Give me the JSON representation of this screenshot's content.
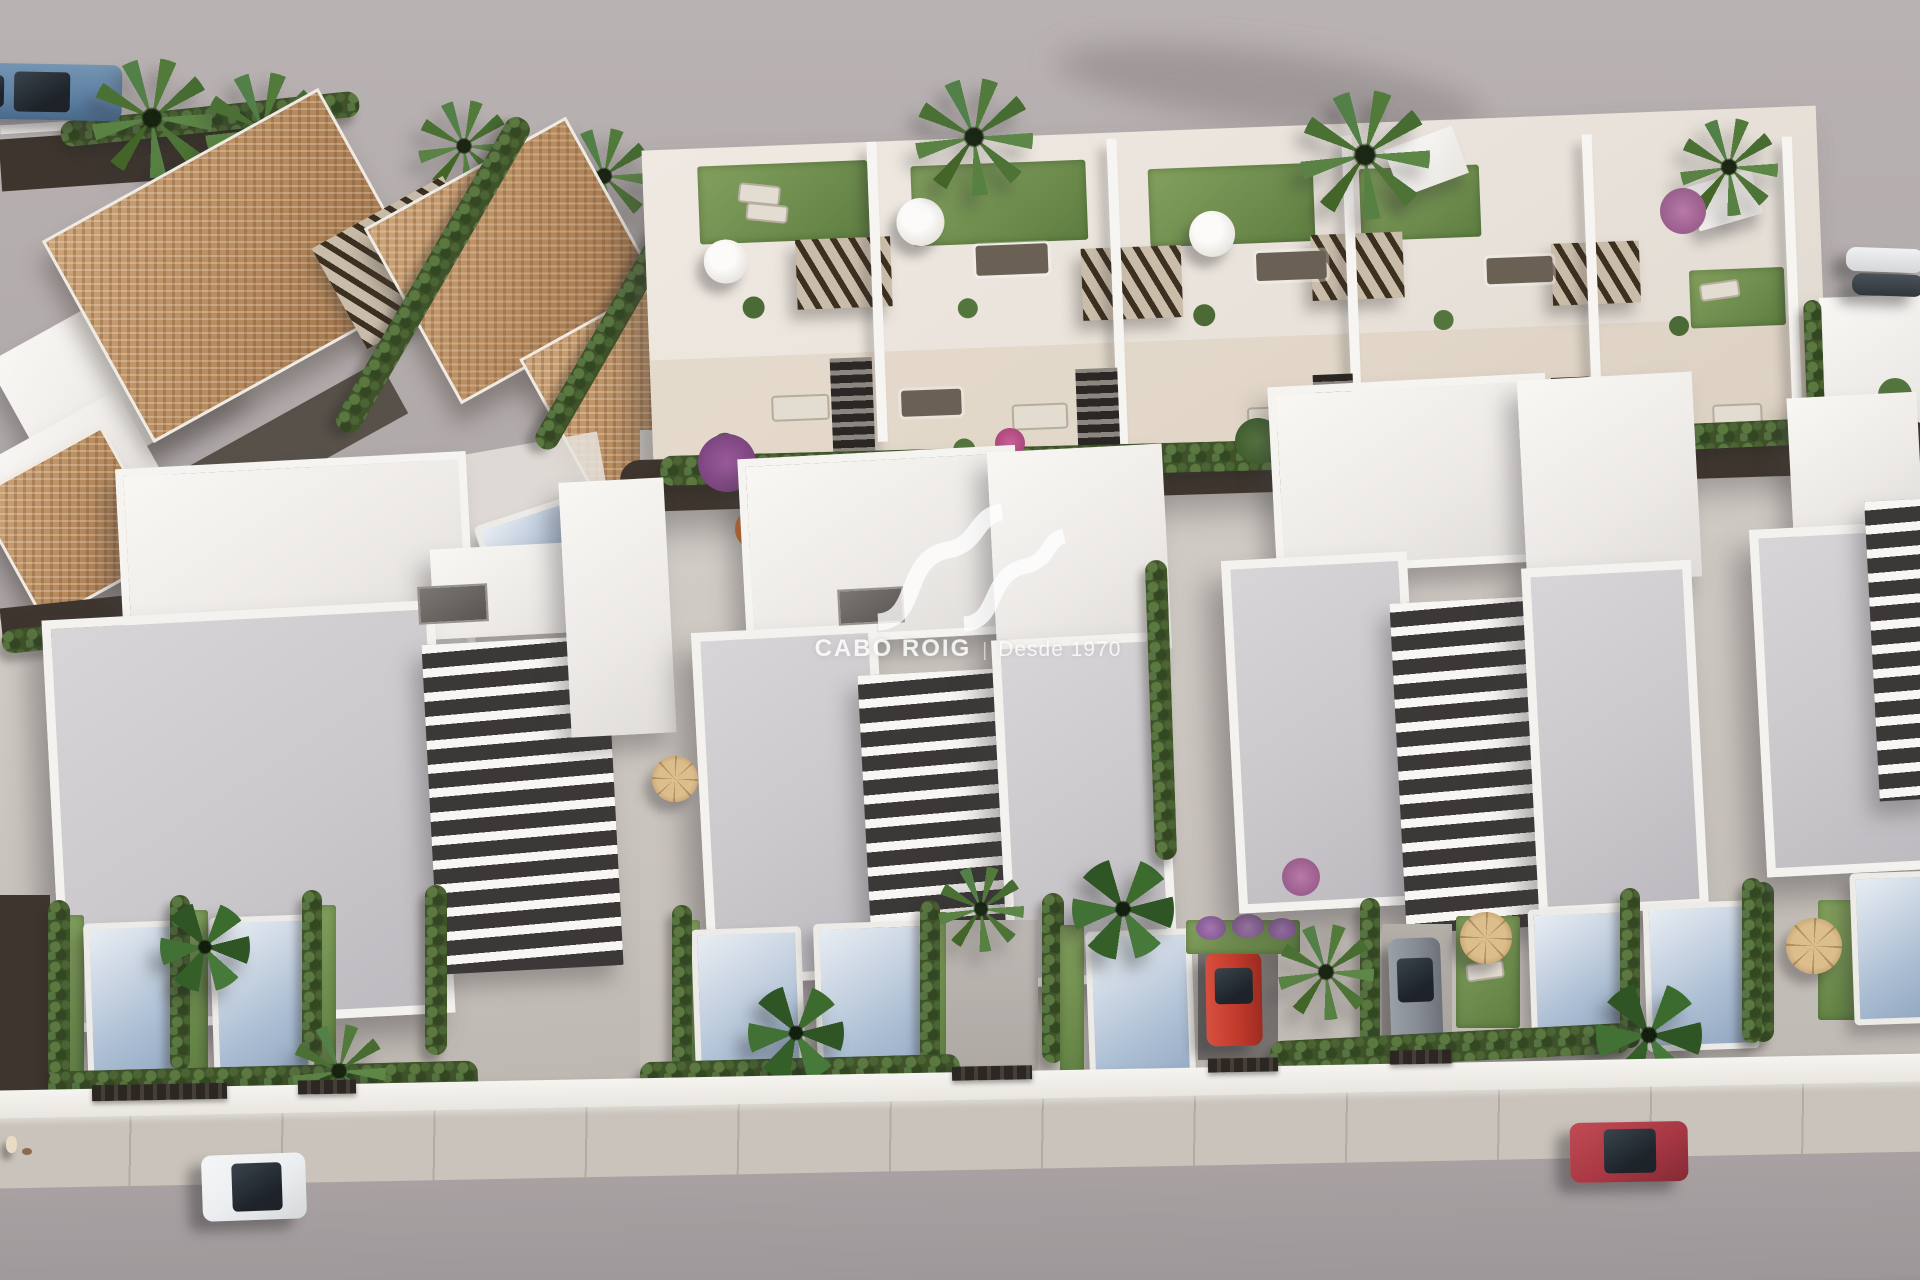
{
  "image": {
    "kind": "aerial-3d-architectural-render",
    "subject": "new-build residential development: terracotta-roof villas, rooftop-terrace townhouses, white villas with private pools, street with parked cars"
  },
  "watermark": {
    "brand": "CABO ROIG",
    "separator": "|",
    "tagline": "Desde 1970",
    "logo": "double-wave-monogram"
  },
  "palette": {
    "ground_top": "#b9b2b2",
    "road": "#a59ea0",
    "road_dark": "#9b9496",
    "sidewalk": "#c9c3bb",
    "wall_white": "#f4f2ee",
    "roof_gray": "#cbc8cc",
    "terracotta": "#b68a5d",
    "terracotta_dark": "#9c7047",
    "pergola_brown": "#4a3b2c",
    "lawn": "#5e7e41",
    "hedge": "#3f5229",
    "pool": "#a9bcd2",
    "pool_deep": "#90a6c0",
    "soil": "#3e362e",
    "flower_purple": "#9c5a9e",
    "flower_magenta": "#b6487e",
    "flower_orange": "#c2662c",
    "straw": "#dcbd8c",
    "car_blue": "#5d80a2",
    "car_white": "#eceff1",
    "car_red": "#c23a2c",
    "car_darkred": "#a83844",
    "car_gray": "#868b93"
  },
  "objects": {
    "vehicles": [
      "blue-suv-top-left",
      "white-hatchback-on-street",
      "dark-red-car-on-street",
      "red-car-in-carport",
      "gray-car-in-driveway",
      "parked-cars-top-right"
    ],
    "vegetation": [
      "palm-trees",
      "cypress-hedges",
      "banana-plants",
      "bougainvillea",
      "rooftop-lawns"
    ],
    "amenities": [
      "white-parasols",
      "straw-parasols",
      "dining-sets",
      "sun-loungers",
      "private-pools",
      "pergolas",
      "roof-terraces"
    ],
    "figures": [
      "person-on-terrace",
      "pedestrian-on-sidewalk"
    ]
  }
}
